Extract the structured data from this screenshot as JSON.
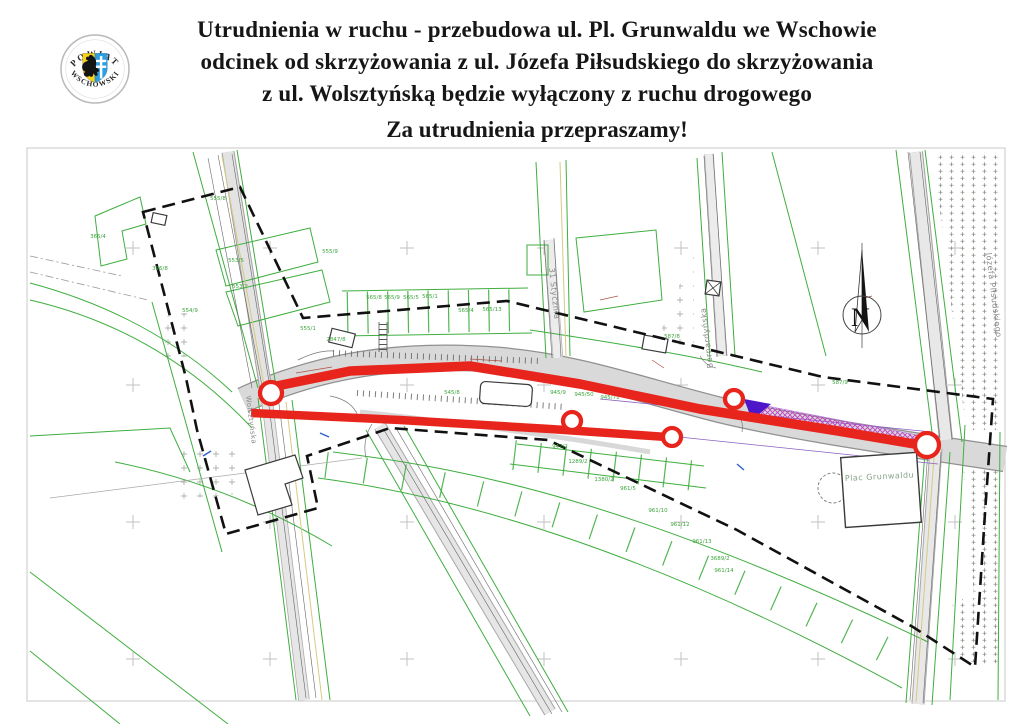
{
  "header": {
    "logo": {
      "arc_top": "POWIAT",
      "arc_bottom": "WSCHOWSKI"
    },
    "title_lines": [
      "Utrudnienia w ruchu - przebudowa ul. Pl. Grunwaldu we Wschowie",
      "odcinek od skrzyżowania z ul. Józefa Piłsudskiego do skrzyżowania",
      "z ul. Wolsztyńską będzie wyłączony z ruchu drogowego"
    ],
    "apology": "Za utrudnienia przepraszamy!"
  },
  "map": {
    "north_label": "N",
    "street_labels": [
      {
        "text": "31 Stycznia",
        "x": 549,
        "y": 268,
        "rotate": 84,
        "size": 8,
        "color": "#8a8a8a"
      },
      {
        "text": "Bernardyńska",
        "x": 713,
        "y": 368,
        "rotate": -97,
        "size": 8,
        "color": "#8a8a8a"
      },
      {
        "text": "Józefa Piłsudskiego",
        "x": 986,
        "y": 253,
        "rotate": 83,
        "size": 8,
        "color": "#8a8a8a"
      },
      {
        "text": "Wolsztyńska",
        "x": 246,
        "y": 396,
        "rotate": 83,
        "size": 7,
        "color": "#8a8a8a"
      },
      {
        "text": "Plac Grunwaldu",
        "x": 845,
        "y": 481,
        "rotate": -3,
        "size": 8,
        "color": "#85a385"
      }
    ],
    "parcel_labels": [
      {
        "text": "555/8",
        "x": 218,
        "y": 200
      },
      {
        "text": "365/4",
        "x": 98,
        "y": 238
      },
      {
        "text": "396/8",
        "x": 160,
        "y": 270
      },
      {
        "text": "553/5",
        "x": 236,
        "y": 262
      },
      {
        "text": "553/2",
        "x": 240,
        "y": 288
      },
      {
        "text": "555/9",
        "x": 330,
        "y": 253
      },
      {
        "text": "554/9",
        "x": 190,
        "y": 312
      },
      {
        "text": "555/1",
        "x": 308,
        "y": 330
      },
      {
        "text": "2847/8",
        "x": 336,
        "y": 341
      },
      {
        "text": "565/8",
        "x": 374,
        "y": 299
      },
      {
        "text": "565/9",
        "x": 392,
        "y": 299
      },
      {
        "text": "565/5",
        "x": 411,
        "y": 299
      },
      {
        "text": "565/1",
        "x": 430,
        "y": 298
      },
      {
        "text": "565/4",
        "x": 466,
        "y": 312
      },
      {
        "text": "565/13",
        "x": 492,
        "y": 311
      },
      {
        "text": "587/8",
        "x": 672,
        "y": 338
      },
      {
        "text": "587/9",
        "x": 840,
        "y": 384
      },
      {
        "text": "545/8",
        "x": 452,
        "y": 394
      },
      {
        "text": "945/9",
        "x": 558,
        "y": 394
      },
      {
        "text": "945/50",
        "x": 584,
        "y": 396
      },
      {
        "text": "945/71",
        "x": 610,
        "y": 399
      },
      {
        "text": "947/2",
        "x": 560,
        "y": 448
      },
      {
        "text": "1289/2",
        "x": 578,
        "y": 463
      },
      {
        "text": "1380/2",
        "x": 604,
        "y": 481
      },
      {
        "text": "961/5",
        "x": 628,
        "y": 490
      },
      {
        "text": "961/10",
        "x": 658,
        "y": 512
      },
      {
        "text": "961/12",
        "x": 680,
        "y": 526
      },
      {
        "text": "961/13",
        "x": 702,
        "y": 543
      },
      {
        "text": "3689/2",
        "x": 720,
        "y": 560
      },
      {
        "text": "961/14",
        "x": 724,
        "y": 572
      }
    ],
    "closures": {
      "color": "#e8251c",
      "lines": [
        {
          "width": 9.5,
          "points": [
            [
              262,
              389
            ],
            [
              350,
              371
            ],
            [
              470,
              366
            ],
            [
              580,
              384
            ],
            [
              700,
              409
            ],
            [
              838,
              431
            ],
            [
              926,
              446
            ]
          ]
        },
        {
          "width": 8.5,
          "points": [
            [
              251,
              413
            ],
            [
              400,
              420
            ],
            [
              550,
              429
            ],
            [
              667,
              437
            ]
          ]
        }
      ],
      "markers": [
        {
          "x": 271,
          "y": 393,
          "r": 13
        },
        {
          "x": 572,
          "y": 421,
          "r": 11
        },
        {
          "x": 672,
          "y": 437,
          "r": 11
        },
        {
          "x": 734,
          "y": 399,
          "r": 11
        },
        {
          "x": 927,
          "y": 445,
          "r": 14
        }
      ]
    },
    "work_zone": {
      "hatch_color": "#c23ac2",
      "accent_color": "#4d17c9"
    },
    "grid_marks": {
      "xs": [
        133,
        270,
        407,
        544,
        681,
        818,
        955
      ],
      "ys": [
        248,
        385,
        522,
        659
      ]
    }
  }
}
